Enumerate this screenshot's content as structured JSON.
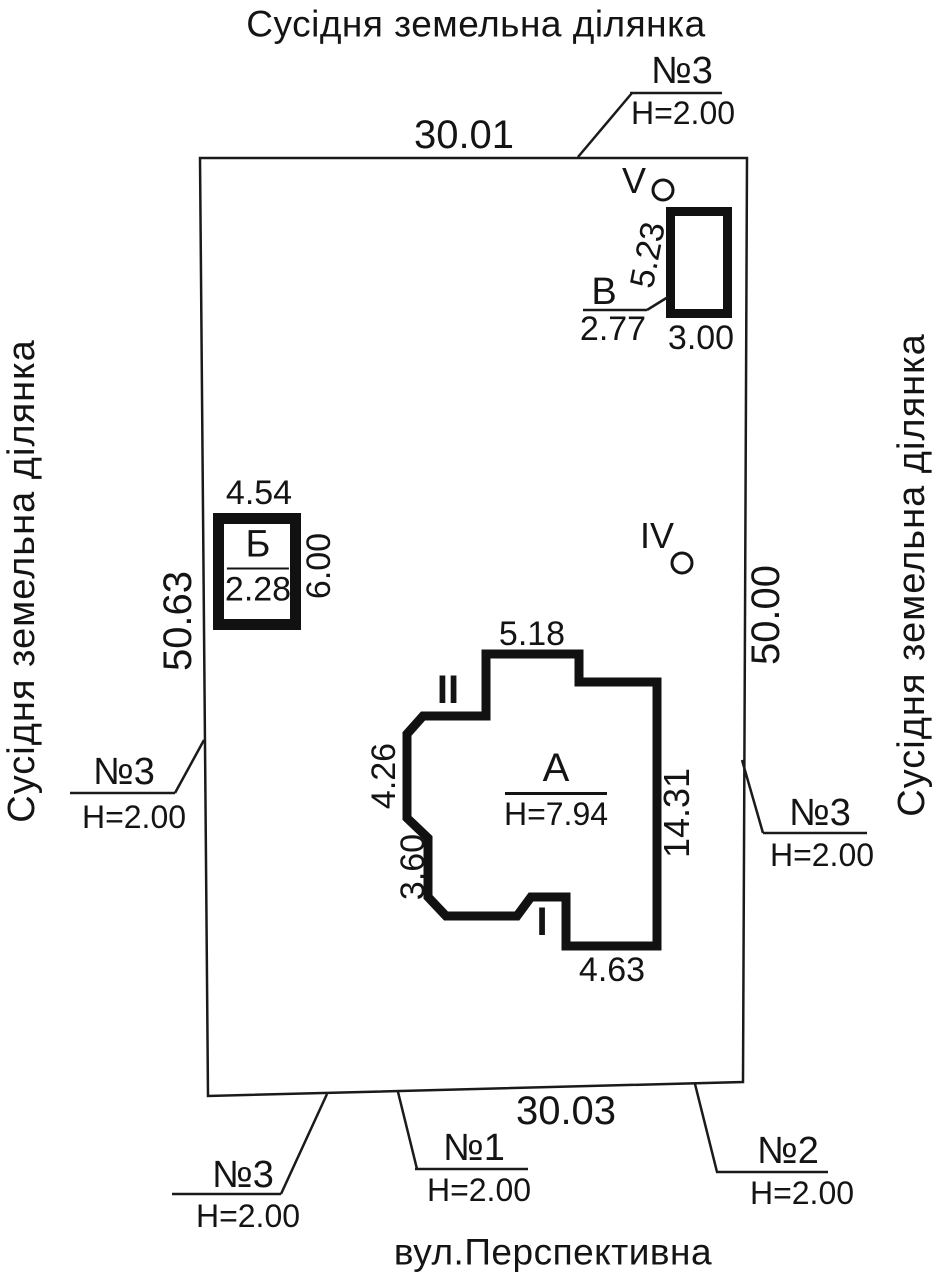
{
  "titles": {
    "top": "Сусідня земельна ділянка",
    "left": "Сусідня земельна ділянка",
    "right": "Сусідня земельна ділянка",
    "street": "вул.Перспективна"
  },
  "plot": {
    "dim_top": "30.01",
    "dim_bottom": "30.03",
    "dim_left": "50.63",
    "dim_right": "50.00"
  },
  "fences": {
    "top": {
      "label": "№3",
      "height": "H=2.00"
    },
    "left": {
      "label": "№3",
      "height": "H=2.00"
    },
    "right": {
      "label": "№3",
      "height": "H=2.00"
    },
    "bottom_left": {
      "label": "№3",
      "height": "H=2.00"
    },
    "bottom_mid": {
      "label": "№1",
      "height": "H=2.00"
    },
    "bottom_right": {
      "label": "№2",
      "height": "H=2.00"
    }
  },
  "buildings": {
    "a": {
      "label": "А",
      "height": "H=7.94",
      "dim_top": "5.18",
      "dim_left_upper": "4.26",
      "dim_left_lower": "3.60",
      "dim_right": "14.31",
      "dim_bottom": "4.63",
      "mark_upper": "II",
      "mark_lower": "I"
    },
    "b": {
      "label": "Б",
      "value": "2.28",
      "dim_width": "4.54",
      "dim_height": "6.00"
    },
    "v": {
      "label": "В",
      "value": "2.77",
      "dim_height": "5.23",
      "dim_width": "3.00"
    }
  },
  "points": {
    "v": "V",
    "iv": "IV"
  }
}
